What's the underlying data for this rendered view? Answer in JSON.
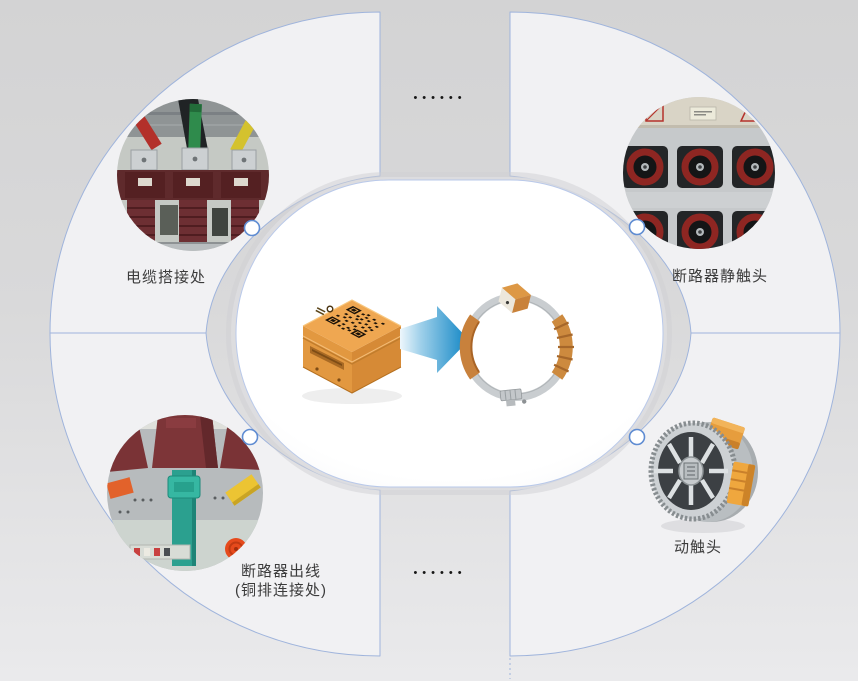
{
  "colors": {
    "background_top": "#d3d3d4",
    "background_bottom": "#eaeaec",
    "panel_fill": "#f1f1f3",
    "accent_border": "#9fb4dc",
    "node_border": "#5f8cd2",
    "label_text": "#3b3b3b",
    "arrow_blue": "#0d84c4",
    "sensor_orange": "#eda24c",
    "clamp_orange": "#c9803a"
  },
  "decor": {
    "dots_top": "••••••",
    "dots_bottom": "••••••"
  },
  "hotspots": {
    "cable_joint": {
      "label": "电缆搭接处"
    },
    "breaker_static_contact": {
      "label": "断路器静触头"
    },
    "breaker_outlet": {
      "label_line1": "断路器出线",
      "label_line2": "(铜排连接处)"
    },
    "moving_contact": {
      "label": "动触头"
    }
  }
}
